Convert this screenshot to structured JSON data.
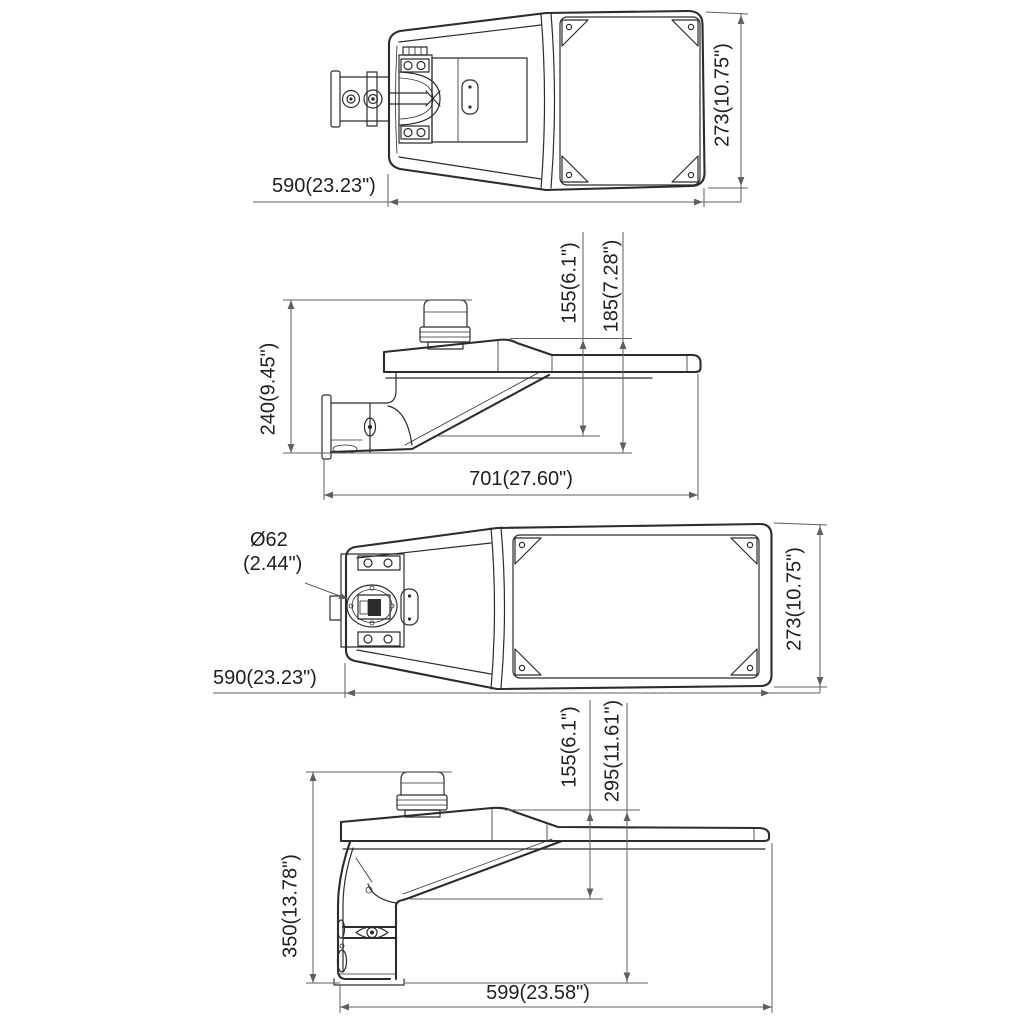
{
  "drawing": {
    "title_hint": "street light luminaire dimensional drawing",
    "background": "#ffffff",
    "line_color": "#2c2c2c",
    "dim_color": "#5f5f5f",
    "text_color": "#1f1f1f",
    "views": {
      "top": {
        "width": "590(23.23\")",
        "height": "273(10.75\")"
      },
      "side_horizontal_mount": {
        "overall_height": "240(9.45\")",
        "depth_to_body": "155(6.1\")",
        "depth_to_arm": "185(7.28\")",
        "overall_length": "701(27.60\")"
      },
      "bottom": {
        "pole_diameter": "Ø62",
        "pole_diameter_inches": "(2.44\")",
        "width": "590(23.23\")",
        "height": "273(10.75\")"
      },
      "side_vertical_mount": {
        "depth_to_body": "155(6.1\")",
        "depth_to_bracket": "295(11.61\")",
        "overall_height": "350(13.78\")",
        "overall_length": "599(23.58\")"
      }
    }
  }
}
